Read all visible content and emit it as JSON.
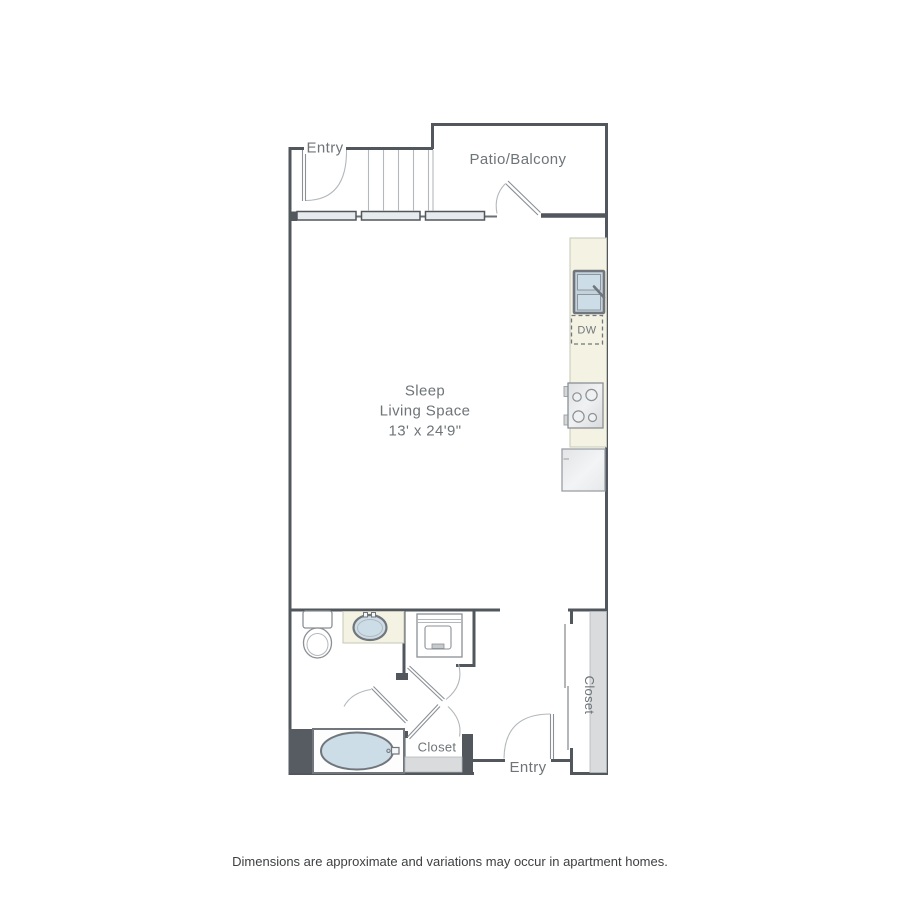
{
  "floorplan": {
    "labels": {
      "entry_top": "Entry",
      "patio_balcony": "Patio/Balcony",
      "sleep_line1": "Sleep",
      "sleep_line2": "Living Space",
      "sleep_dimensions": "13' x 24'9\"",
      "dishwasher": "DW",
      "closet_right": "Closet",
      "closet_bottom": "Closet",
      "entry_bottom": "Entry"
    },
    "footer": "Dimensions are approximate and variations may occur in apartment homes."
  },
  "colors": {
    "wall": "#51575d",
    "wall_thin": "#6a7076",
    "line_light": "#b3b8bc",
    "line_med": "#8a9095",
    "fixture_stroke": "#70767c",
    "counter_cream": "#f4f2e2",
    "counter_edge": "#c6c8ba",
    "fixture_blue": "#ccdde8",
    "window_fill": "#e8ebed",
    "closet_floor": "#d9dbdd",
    "dark_block": "#565c62",
    "appliance_fill": "#e3e5e7",
    "label": "#6e7478",
    "footer_text": "#3f4042"
  }
}
